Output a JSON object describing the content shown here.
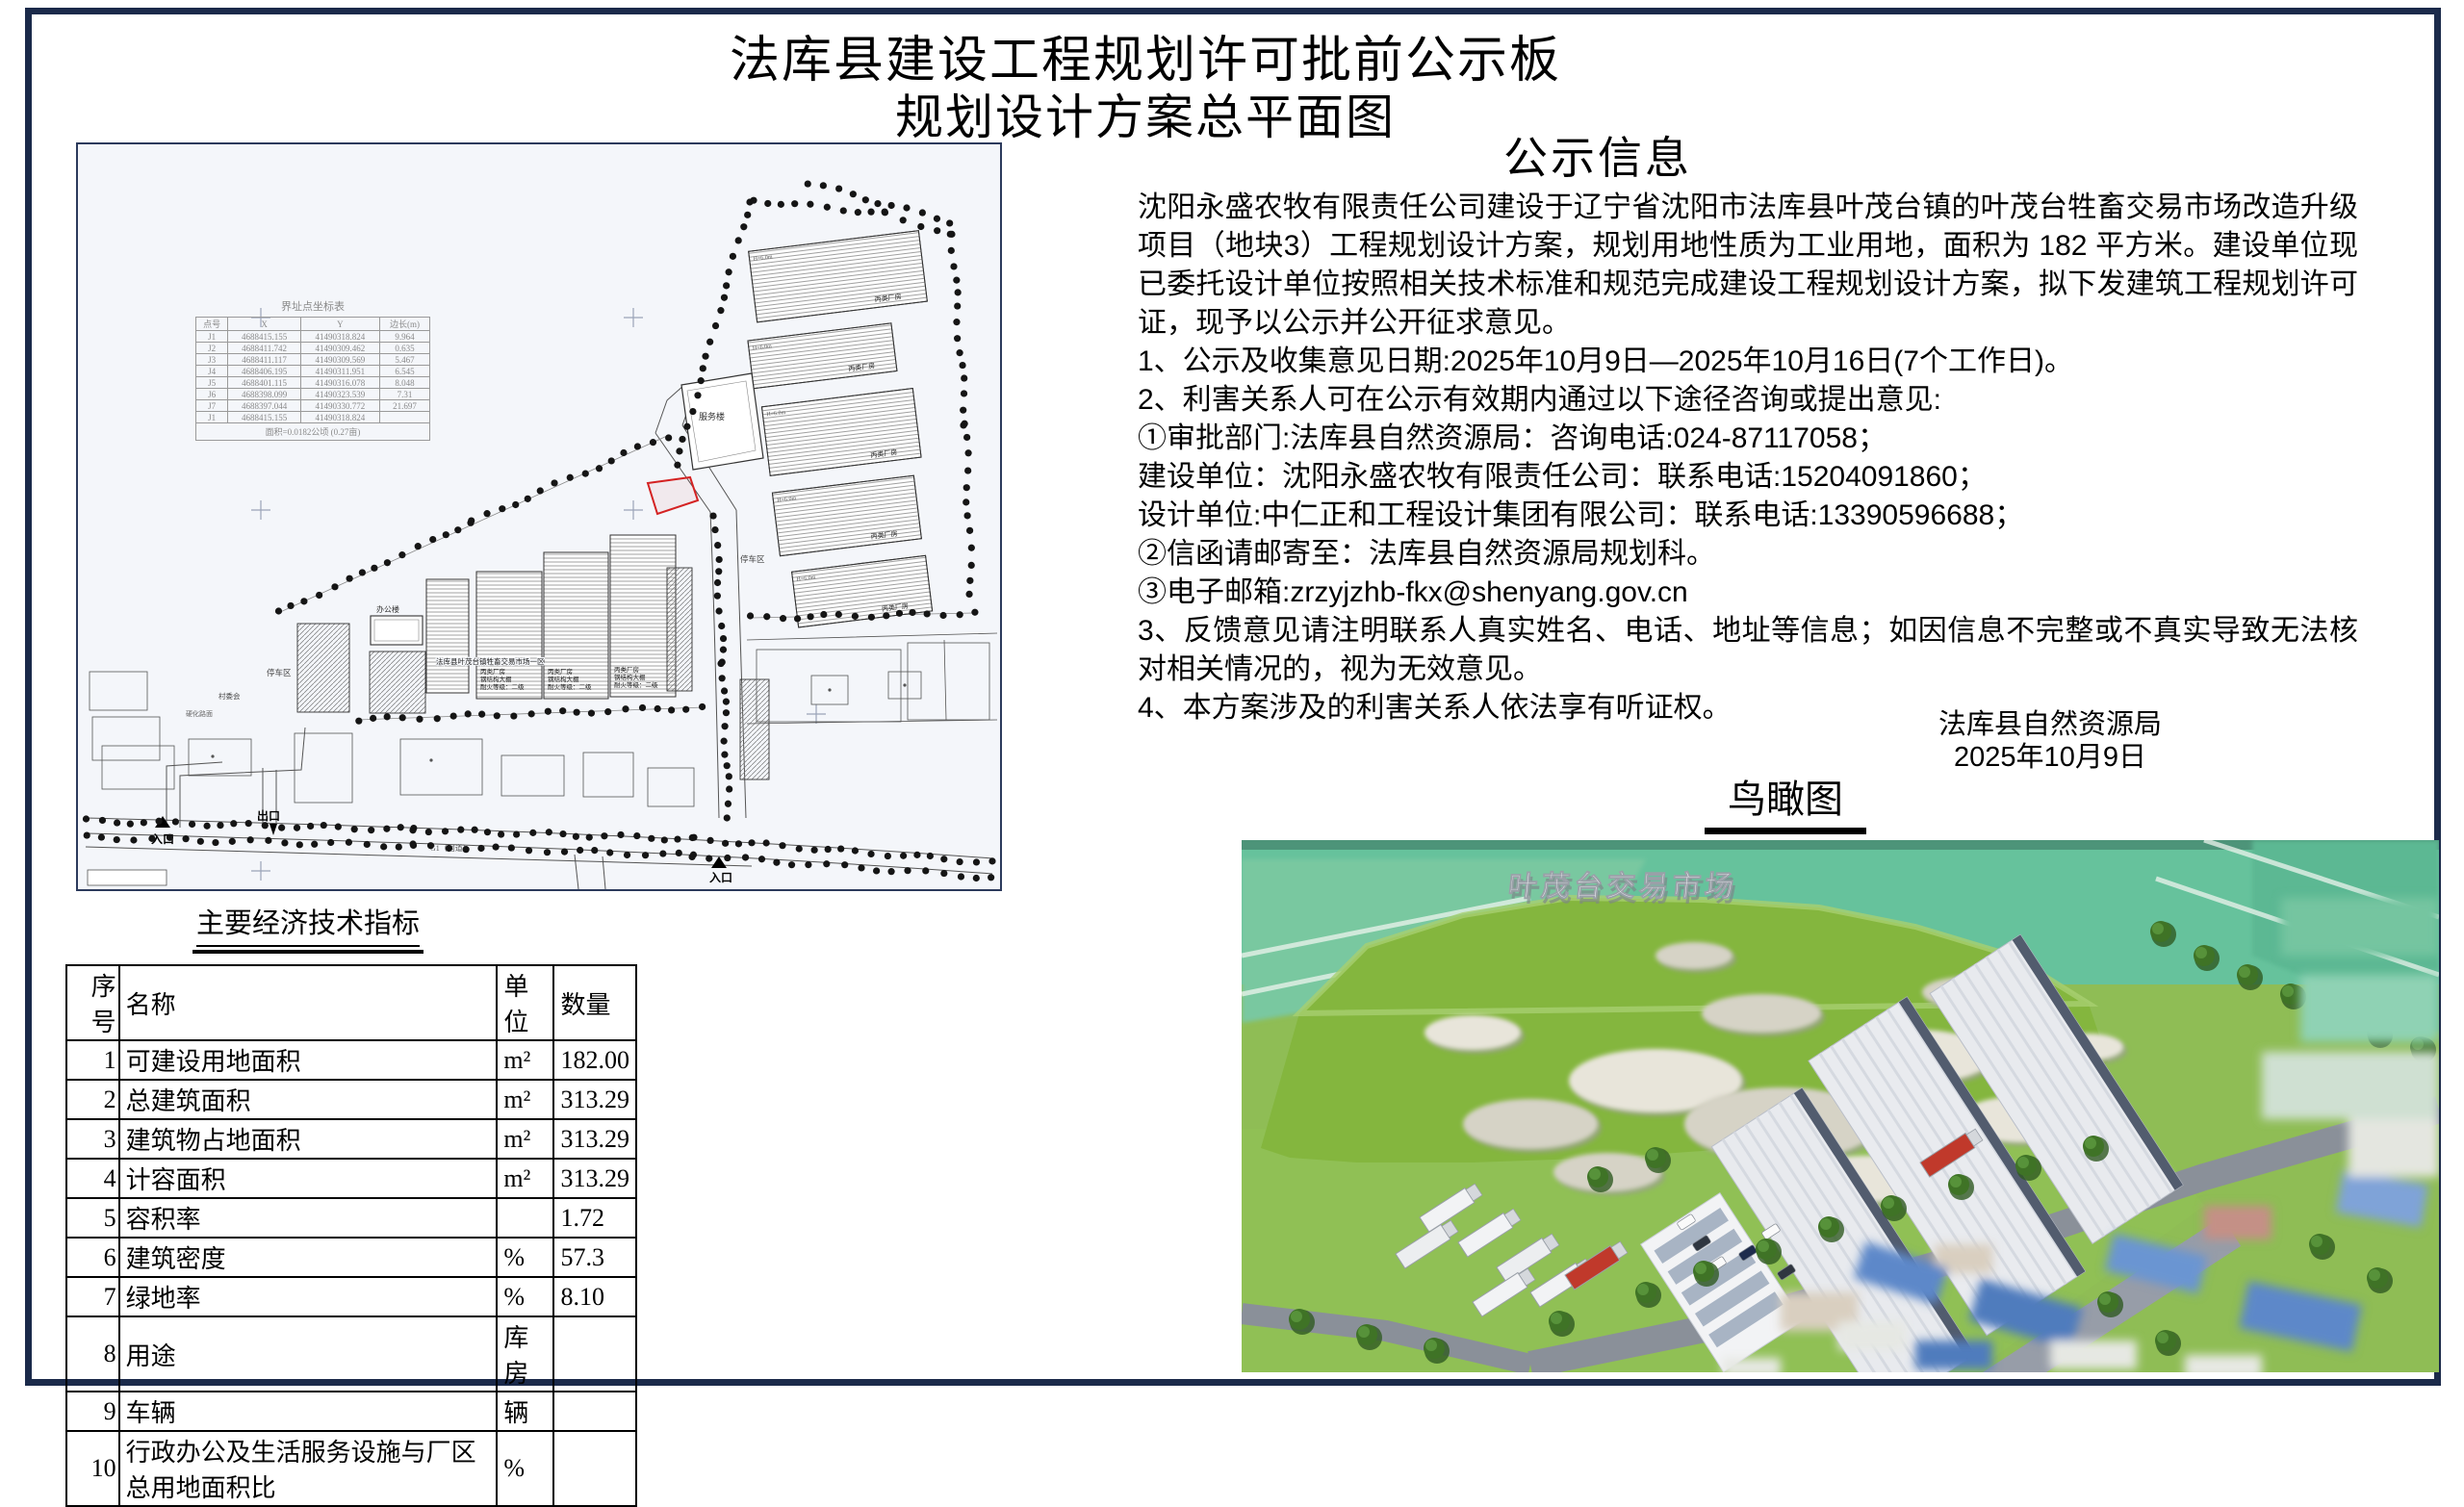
{
  "title": {
    "line1": "法库县建设工程规划许可批前公示板",
    "line2": "规划设计方案总平面图"
  },
  "notice": {
    "heading": "公示信息",
    "paragraphs": [
      "沈阳永盛农牧有限责任公司建设于辽宁省沈阳市法库县叶茂台镇的叶茂台牲畜交易市场改造升级项目（地块3）工程规划设计方案，规划用地性质为工业用地，面积为 182 平方米。建设单位现已委托设计单位按照相关技术标准和规范完成建设工程规划设计方案，拟下发建筑工程规划许可证，现予以公示并公开征求意见。",
      "1、公示及收集意见日期:2025年10月9日—2025年10月16日(7个工作日)。",
      "2、利害关系人可在公示有效期内通过以下途径咨询或提出意见:",
      "①审批部门:法库县自然资源局：咨询电话:024-87117058；",
      "建设单位：沈阳永盛农牧有限责任公司：联系电话:15204091860；",
      "设计单位:中仁正和工程设计集团有限公司：联系电话:13390596688；",
      "②信函请邮寄至：法库县自然资源局规划科。",
      "③电子邮箱:zrzyjzhb-fkx@shenyang.gov.cn",
      "3、反馈意见请注明联系人真实姓名、电话、地址等信息；如因信息不完整或不真实导致无法核对相关情况的，视为无效意见。",
      "4、本方案涉及的利害关系人依法享有听证权。"
    ],
    "signature": {
      "org": "法库县自然资源局",
      "date": "2025年10月9日"
    }
  },
  "site_plan": {
    "boundary_table": {
      "title": "界址点坐标表",
      "headers": [
        "点号",
        "X",
        "Y",
        "边长(m)"
      ],
      "rows": [
        [
          "J1",
          "4688415.155",
          "41490318.824",
          "9.964"
        ],
        [
          "J2",
          "4688411.742",
          "41490309.462",
          "0.635"
        ],
        [
          "J3",
          "4688411.117",
          "41490309.569",
          "5.467"
        ],
        [
          "J4",
          "4688406.195",
          "41490311.951",
          "6.545"
        ],
        [
          "J5",
          "4688401.115",
          "41490316.078",
          "8.048"
        ],
        [
          "J6",
          "4688398.099",
          "41490323.539",
          "7.31"
        ],
        [
          "J7",
          "4688397.044",
          "41490330.772",
          "21.697"
        ],
        [
          "J1",
          "4688415.155",
          "41490318.824",
          ""
        ]
      ],
      "footer": "面积=0.0182公顷 (0.27亩)"
    },
    "labels": {
      "entrance": "入口",
      "exit": "出口",
      "entrance2": "入口",
      "service_building": "服务楼",
      "office_building": "办公楼",
      "parking_zone": "停车区",
      "parking_zone2": "停车区",
      "village_committee": "村委会",
      "paved_road": "硬化路面",
      "road_name": "G1（国道）",
      "market_zone": "法库县叶茂台镇牲畜交易市场一区",
      "factory_type": "丙类厂房",
      "structure_type": "钢结构大棚",
      "fire_rating": "耐火等级：二级",
      "height_note": "H=6.0m"
    }
  },
  "econ_table": {
    "title": "主要经济技术指标",
    "headers": [
      "序号",
      "名称",
      "单位",
      "数量"
    ],
    "rows": [
      [
        "1",
        "可建设用地面积",
        "m²",
        "182.00"
      ],
      [
        "2",
        "总建筑面积",
        "m²",
        "313.29"
      ],
      [
        "3",
        "建筑物占地面积",
        "m²",
        "313.29"
      ],
      [
        "4",
        "计容面积",
        "m²",
        "313.29"
      ],
      [
        "5",
        "容积率",
        "",
        "1.72"
      ],
      [
        "6",
        "建筑密度",
        "%",
        "57.3"
      ],
      [
        "7",
        "绿地率",
        "%",
        "8.10"
      ],
      [
        "8",
        "用途",
        "库房",
        ""
      ],
      [
        "9",
        "车辆",
        "辆",
        ""
      ],
      [
        "10",
        "行政办公及生活服务设施与厂区总用地面积比",
        "%",
        ""
      ]
    ]
  },
  "aerial": {
    "heading": "鸟瞰图",
    "sign_text": "叶茂台交易市场"
  },
  "colors": {
    "frame": "#1b2a4a",
    "plan_bg": "#f4f6fa",
    "parcel_highlight": "#d42222",
    "hill_green": "#84b63e",
    "lawn_green": "#90c055",
    "field_teal": "#66c29c",
    "roof_blue": "#5d88c9"
  }
}
